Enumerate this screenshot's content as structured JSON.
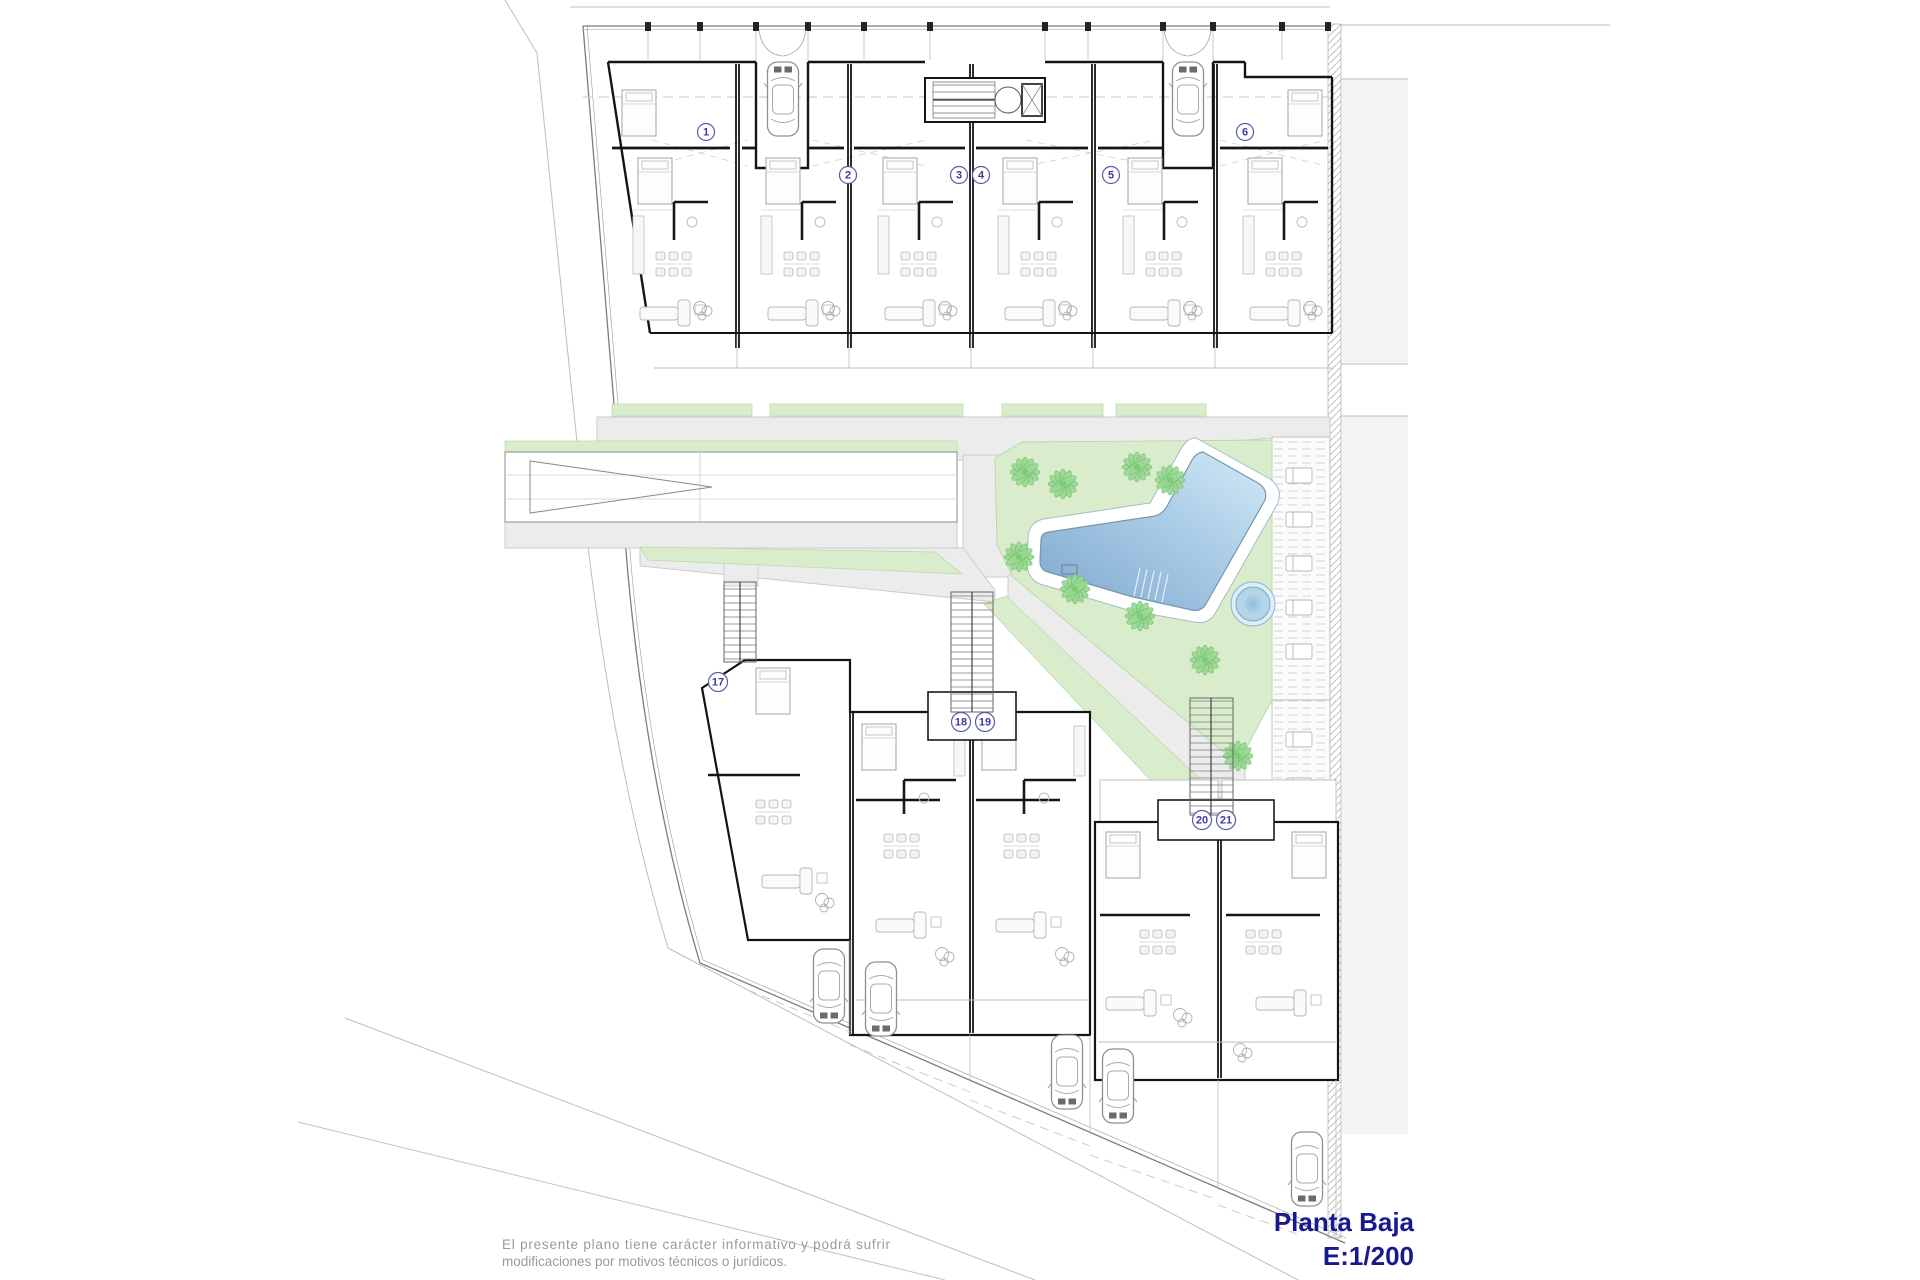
{
  "title_block": {
    "floor_label": "Planta Baja",
    "scale_label": "E:1/200"
  },
  "disclaimer": {
    "line1": "El presente plano tiene carácter informativo y podrá sufrir",
    "line2": "modificaciones por motivos técnicos o jurídicos."
  },
  "unit_numbers": {
    "top_row": [
      "1",
      "2",
      "3",
      "4",
      "5",
      "6"
    ],
    "bottom_row": [
      "17",
      "18",
      "19",
      "20",
      "21"
    ]
  },
  "features": {
    "pool_icon": "swimming-pool",
    "jacuzzi_icon": "jacuzzi",
    "tree_icon": "palm-tree",
    "car_icon": "parked-car",
    "stairs_icon": "staircase",
    "ramp_icon": "garage-ramp-arrow"
  },
  "colors": {
    "title": "#19198f",
    "disclaimer_text": "#9a9a9a",
    "lawn": "#d9edcc",
    "tree": "#98d693",
    "pool_deep": "#86afd3",
    "pool_shallow": "#cfe7f5",
    "path": "#ececec",
    "wall": "#141414",
    "neighbor_plot": "#f4f4f4"
  }
}
